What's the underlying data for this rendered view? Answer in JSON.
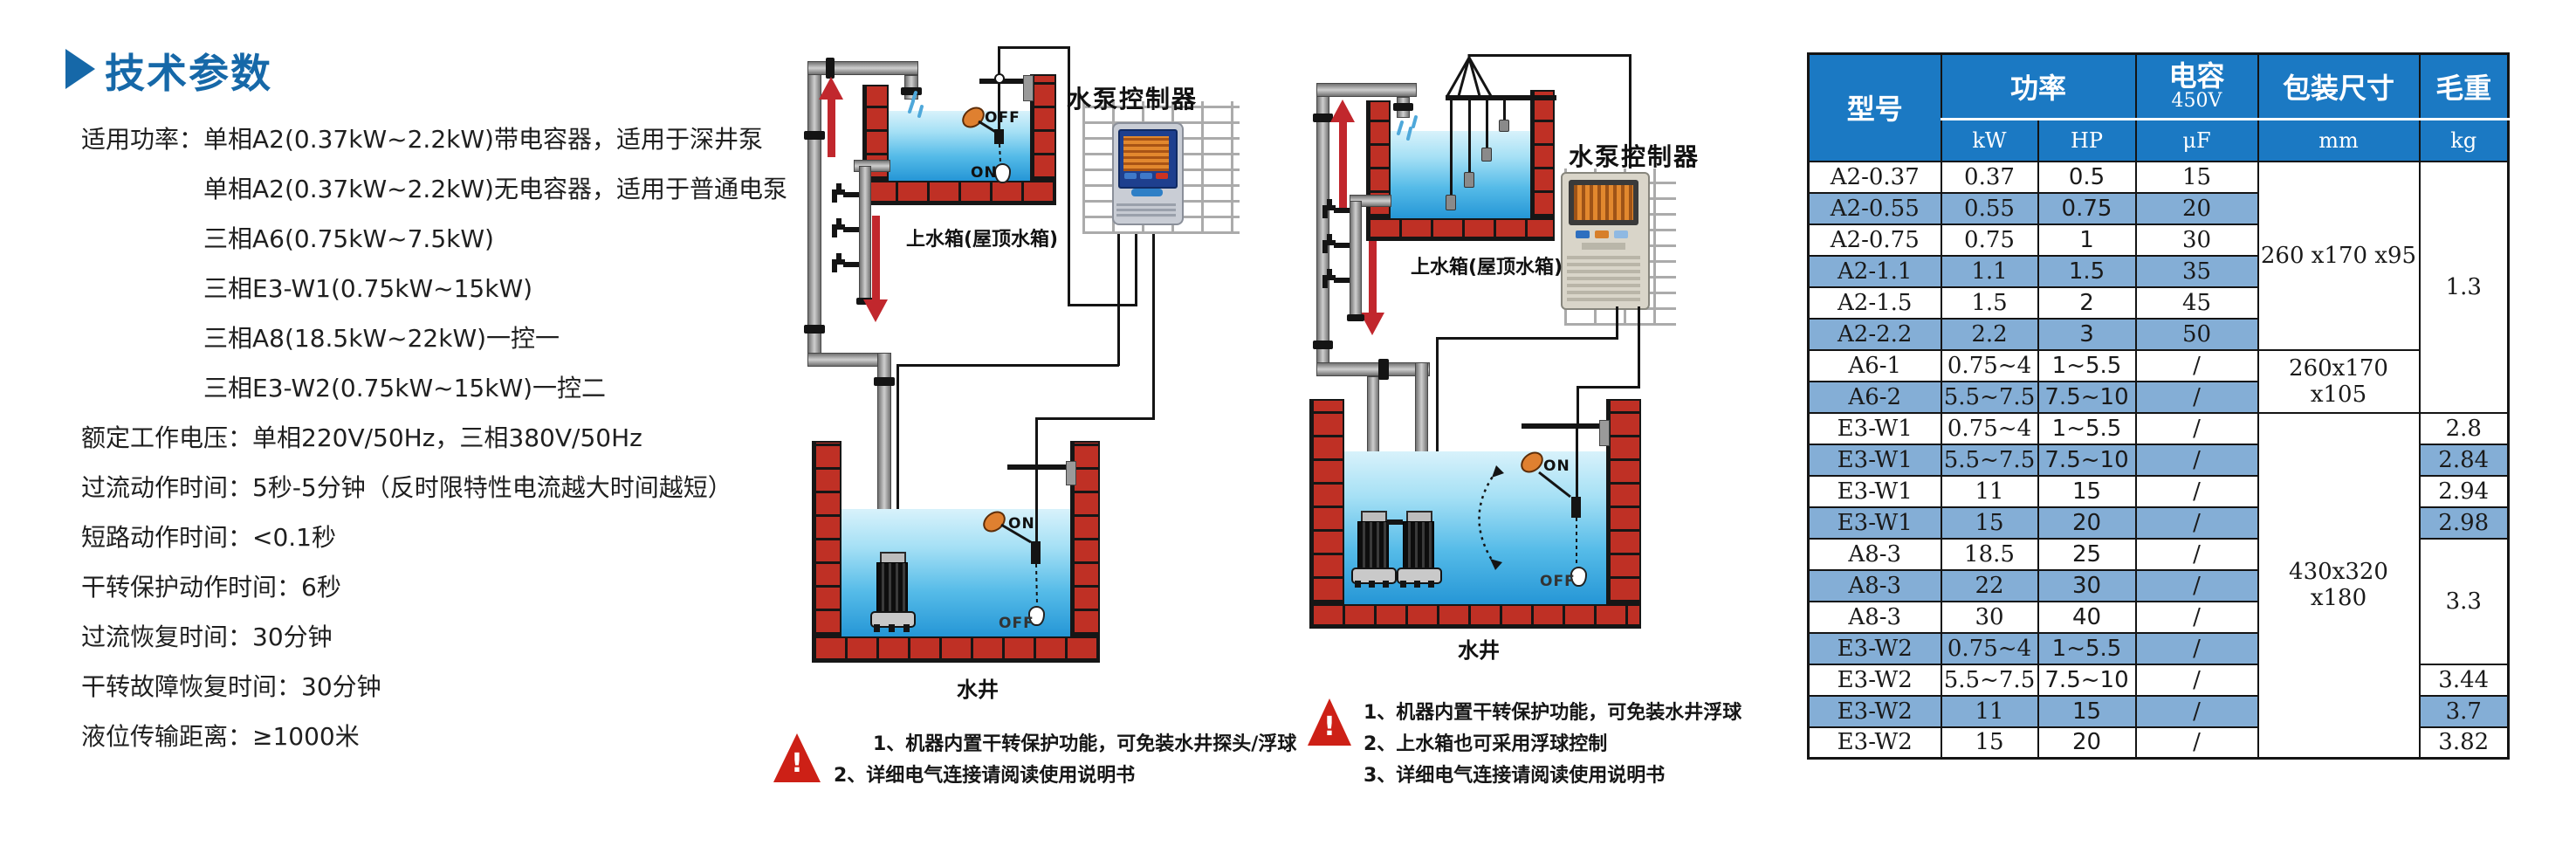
{
  "colors": {
    "heading_blue": "#1668a8",
    "table_header_blue": "#1b79c3",
    "table_stripe_blue": "#84aed6",
    "brick_red": "#bf3025",
    "arrow_red": "#c1272d",
    "warning_red": "#cd2016",
    "water_blue": "#2ba3dd",
    "controller_accent_blue": "#2e7fc6"
  },
  "specs": {
    "heading": "技术参数",
    "lines": [
      {
        "text": "适用功率：单相A2(0.37kW~2.2kW)带电容器，适用于深井泵",
        "indent": 0
      },
      {
        "text": "单相A2(0.37kW~2.2kW)无电容器，适用于普通电泵",
        "indent": 1
      },
      {
        "text": "三相A6(0.75kW~7.5kW)",
        "indent": 1
      },
      {
        "text": "三相E3-W1(0.75kW~15kW)",
        "indent": 1
      },
      {
        "text": "三相A8(18.5kW~22kW)一控一",
        "indent": 1
      },
      {
        "text": "三相E3-W2(0.75kW~15kW)一控二",
        "indent": 1
      },
      {
        "text": "额定工作电压：单相220V/50Hz，三相380V/50Hz",
        "indent": 0
      },
      {
        "text": "过流动作时间：5秒-5分钟（反时限特性电流越大时间越短）",
        "indent": 0
      },
      {
        "text": "短路动作时间：<0.1秒",
        "indent": 0
      },
      {
        "text": "干转保护动作时间：6秒",
        "indent": 0
      },
      {
        "text": "过流恢复时间：30分钟",
        "indent": 0
      },
      {
        "text": "干转故障恢复时间：30分钟",
        "indent": 0
      },
      {
        "text": "液位传输距离：≥1000米",
        "indent": 0
      }
    ]
  },
  "diagram1": {
    "controller_label": "水泵控制器",
    "tank_label": "上水箱(屋顶水箱)",
    "well_label": "水井",
    "float_on": "ON",
    "float_off": "OFF",
    "notes": [
      "1、机器内置干转保护功能，可免装水井探头/浮球",
      "2、详细电气连接请阅读使用说明书"
    ]
  },
  "diagram2": {
    "controller_label": "水泵控制器",
    "tank_label": "上水箱(屋顶水箱)",
    "well_label": "水井",
    "float_on": "ON",
    "float_off": "OFF",
    "notes": [
      "1、机器内置干转保护功能，可免装水井浮球",
      "2、上水箱也可采用浮球控制",
      "3、详细电气连接请阅读使用说明书"
    ]
  },
  "table": {
    "header": {
      "model": "型号",
      "power": "功率",
      "kw": "kW",
      "hp": "HP",
      "capacitance_line1": "电容",
      "capacitance_line2": "450V",
      "uf": "μF",
      "packing": "包装尺寸",
      "mm": "mm",
      "weight": "毛重",
      "kg": "kg"
    },
    "rows": [
      {
        "model": "A2-0.37",
        "kw": "0.37",
        "hp": "0.5",
        "uf": "15"
      },
      {
        "model": "A2-0.55",
        "kw": "0.55",
        "hp": "0.75",
        "uf": "20"
      },
      {
        "model": "A2-0.75",
        "kw": "0.75",
        "hp": "1",
        "uf": "30"
      },
      {
        "model": "A2-1.1",
        "kw": "1.1",
        "hp": "1.5",
        "uf": "35"
      },
      {
        "model": "A2-1.5",
        "kw": "1.5",
        "hp": "2",
        "uf": "45"
      },
      {
        "model": "A2-2.2",
        "kw": "2.2",
        "hp": "3",
        "uf": "50"
      },
      {
        "model": "A6-1",
        "kw": "0.75~4",
        "hp": "1~5.5",
        "uf": "/"
      },
      {
        "model": "A6-2",
        "kw": "5.5~7.5",
        "hp": "7.5~10",
        "uf": "/"
      },
      {
        "model": "E3-W1",
        "kw": "0.75~4",
        "hp": "1~5.5",
        "uf": "/",
        "weight": "2.8"
      },
      {
        "model": "E3-W1",
        "kw": "5.5~7.5",
        "hp": "7.5~10",
        "uf": "/",
        "weight": "2.84"
      },
      {
        "model": "E3-W1",
        "kw": "11",
        "hp": "15",
        "uf": "/",
        "weight": "2.94"
      },
      {
        "model": "E3-W1",
        "kw": "15",
        "hp": "20",
        "uf": "/",
        "weight": "2.98"
      },
      {
        "model": "A8-3",
        "kw": "18.5",
        "hp": "25",
        "uf": "/"
      },
      {
        "model": "A8-3",
        "kw": "22",
        "hp": "30",
        "uf": "/"
      },
      {
        "model": "A8-3",
        "kw": "30",
        "hp": "40",
        "uf": "/"
      },
      {
        "model": "E3-W2",
        "kw": "0.75~4",
        "hp": "1~5.5",
        "uf": "/"
      },
      {
        "model": "E3-W2",
        "kw": "5.5~7.5",
        "hp": "7.5~10",
        "uf": "/",
        "weight": "3.44"
      },
      {
        "model": "E3-W2",
        "kw": "11",
        "hp": "15",
        "uf": "/",
        "weight": "3.7"
      },
      {
        "model": "E3-W2",
        "kw": "15",
        "hp": "20",
        "uf": "/",
        "weight": "3.82"
      }
    ],
    "packing_merges": [
      {
        "start": 0,
        "span": 6,
        "text": "260 x170 x95"
      },
      {
        "start": 6,
        "span": 2,
        "text": "260x170 x105"
      },
      {
        "start": 8,
        "span": 11,
        "text": "430x320 x180"
      }
    ],
    "weight_merges": [
      {
        "start": 0,
        "span": 8,
        "text": "1.3"
      },
      {
        "start": 12,
        "span": 4,
        "text": "3.3"
      }
    ]
  }
}
